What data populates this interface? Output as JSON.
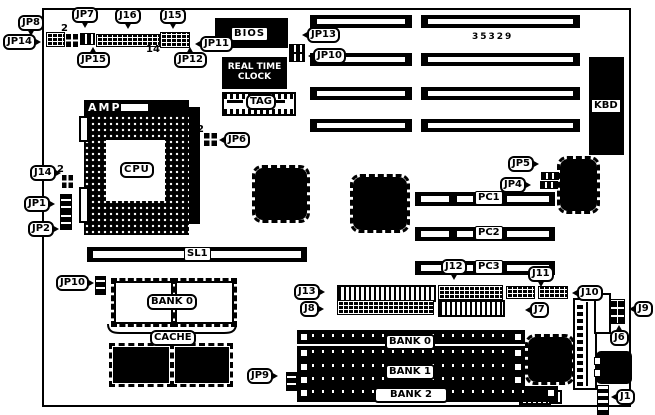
{
  "callouts": {
    "jp8": "JP8",
    "jp14": "JP14",
    "jp7": "JP7",
    "jp15": "JP15",
    "j16": "J16",
    "j15": "J15",
    "jp12": "JP12",
    "jp11": "JP11",
    "jp13": "JP13",
    "jp10_top": "JP10",
    "j14": "J14",
    "jp1": "JP1",
    "jp2": "JP2",
    "jp6": "JP6",
    "jp5": "JP5",
    "jp4": "JP4",
    "jp10_bottom": "JP10",
    "jp9": "JP9",
    "j13": "J13",
    "j8": "J8",
    "j12": "J12",
    "j11": "J11",
    "j10": "J10",
    "j7": "J7",
    "j9": "J9",
    "j6": "J6",
    "j1": "J1"
  },
  "chips": {
    "bios": "BIOS",
    "rtc_line1": "REAL TIME",
    "rtc_line2": "CLOCK",
    "tag": "TAG",
    "kbd": "KBD",
    "amp": "AMP",
    "cpu": "CPU"
  },
  "slots": {
    "pc1": "PC1",
    "pc2": "PC2",
    "pc3": "PC3",
    "sl1": "SL1"
  },
  "memory": {
    "cache_bank": "BANK 0",
    "cache": "CACHE",
    "bank0": "BANK 0",
    "bank1": "BANK 1",
    "bank2": "BANK 2"
  },
  "annotations": {
    "part_number": "35329",
    "jp15_pin": "2",
    "j16_pin": "14",
    "j14_pin": "2",
    "jp6_pin": "2"
  }
}
